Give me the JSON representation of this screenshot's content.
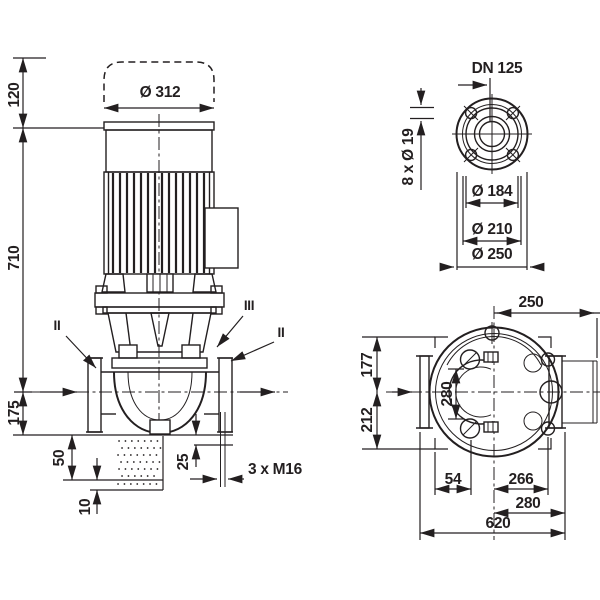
{
  "app": {
    "background": "#ffffff",
    "ink": "#231f20",
    "description": "Inline pump dimensional drawing with three views"
  },
  "front": {
    "clearance": "120",
    "total_height": "710",
    "axis_to_base": "175",
    "motor_dia": "Ø 312",
    "foundation": "50",
    "grout": "10",
    "gap": "25",
    "anchor_bolts": "3 x M16",
    "section_left": "II",
    "section_mid": "III",
    "section_right": "II"
  },
  "flange": {
    "dn": "DN 125",
    "bolt_holes": "8 x Ø 19",
    "d_hub": "Ø 184",
    "d_bolt_circle": "Ø 210",
    "d_outer": "Ø 250"
  },
  "plan": {
    "center_to_face": "250",
    "half_front": "177",
    "half_back": "212",
    "port_span": "280",
    "foot_offset": "54",
    "foot_span": "266",
    "flange_span": "280",
    "overall_length": "620"
  }
}
